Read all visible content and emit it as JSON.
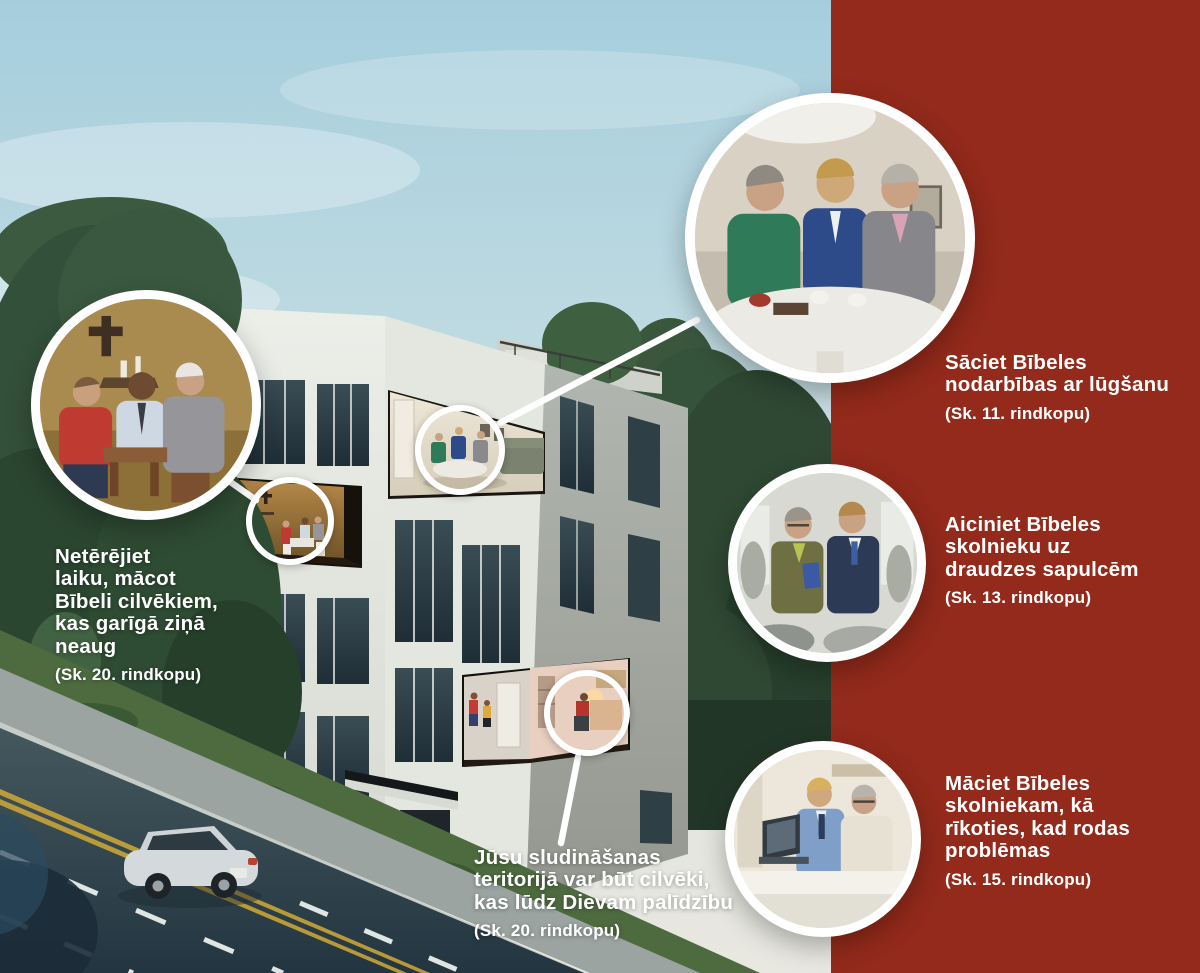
{
  "colors": {
    "panel_red": "#932a1b",
    "text_white": "#ffffff",
    "circle_ring": "#ffffff",
    "connector_line": "#ffffff",
    "sky": "#a5cedd"
  },
  "callouts": {
    "start_study": {
      "text": "Sāciet Bībeles\nnodarbības ar lūgšanu",
      "ref": "(Sk. 11. rindkopu)"
    },
    "invite_meetings": {
      "text": "Aiciniet Bībeles\nskolnieku uz\ndraudzes sapulcēm",
      "ref": "(Sk. 13. rindkopu)"
    },
    "teach_problems": {
      "text": "Māciet Bībeles\nskolniekam, kā\nrīkoties, kad rodas\nproblēmas",
      "ref": "(Sk. 15. rindkopu)"
    },
    "dont_waste": {
      "text": "Netērējiet\nlaiku, mācot\nBībeli cilvēkiem,\nkas garīgā ziņā\nneaug",
      "ref": "(Sk. 20. rindkopu)"
    },
    "territory_prayer": {
      "text": "Jūsu sludināšanas\nteritorijā var būt cilvēki,\nkas lūdz Dievam palīdzību",
      "ref": "(Sk. 20. rindkopu)"
    }
  },
  "photo_circles": {
    "prayer_study": "three men praying at a round table",
    "home_clergy_study": "Bible study in a home with a cross on the wall",
    "kingdom_hall": "two men talking at a congregation meeting",
    "laptop_study": "young man showing a laptop to an older man",
    "inset_living_room": "study group inside top-floor apartment",
    "inset_cross_room": "home with cross inside apartment",
    "inset_praying_woman": "woman praying at home while visitors knock"
  }
}
